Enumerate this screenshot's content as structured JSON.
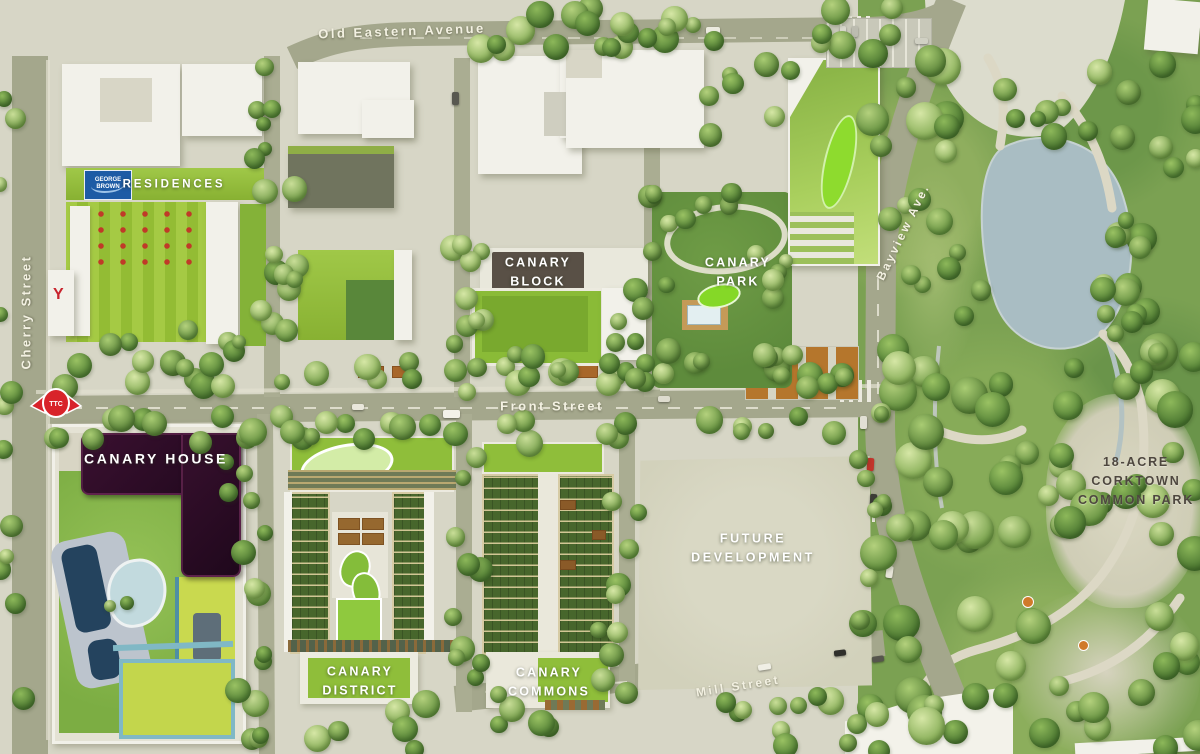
{
  "map": {
    "title": "Canary District site plan",
    "streets": {
      "old_eastern_avenue": "Old Eastern Avenue",
      "cherry_street": "Cherry Street",
      "front_street": "Front Street",
      "mill_street": "Mill Street",
      "bayview_ave": "Bayview Ave."
    },
    "districts": {
      "canary_house": "CANARY HOUSE",
      "canary_block": {
        "line1": "CANARY",
        "line2": "BLOCK"
      },
      "canary_park": {
        "line1": "CANARY",
        "line2": "PARK"
      },
      "canary_district": {
        "line1": "CANARY",
        "line2": "DISTRICT"
      },
      "canary_commons": {
        "line1": "CANARY",
        "line2": "COMMONS"
      },
      "future_development": {
        "line1": "FUTURE",
        "line2": "DEVELOPMENT"
      },
      "corktown_common": {
        "line1": "18-ACRE",
        "line2": "CORKTOWN",
        "line3": "COMMON PARK"
      }
    },
    "buildings": {
      "residences_label": "RESIDENCES",
      "george_brown_logo": "GEORGE BROWN",
      "ymca_logo": "Y"
    },
    "transit": {
      "ttc_logo": "TTC"
    },
    "colors": {
      "ttc_red": "#d8232a",
      "george_brown_blue": "#1d5ba5",
      "ymca_red": "#c8232d",
      "canary_house_dark": "#2e0d26",
      "roof_green": "#93c13d",
      "street_olive": "#a3a68b",
      "water_blue": "#a9bdc3",
      "planter_orange": "#b5762c"
    }
  }
}
